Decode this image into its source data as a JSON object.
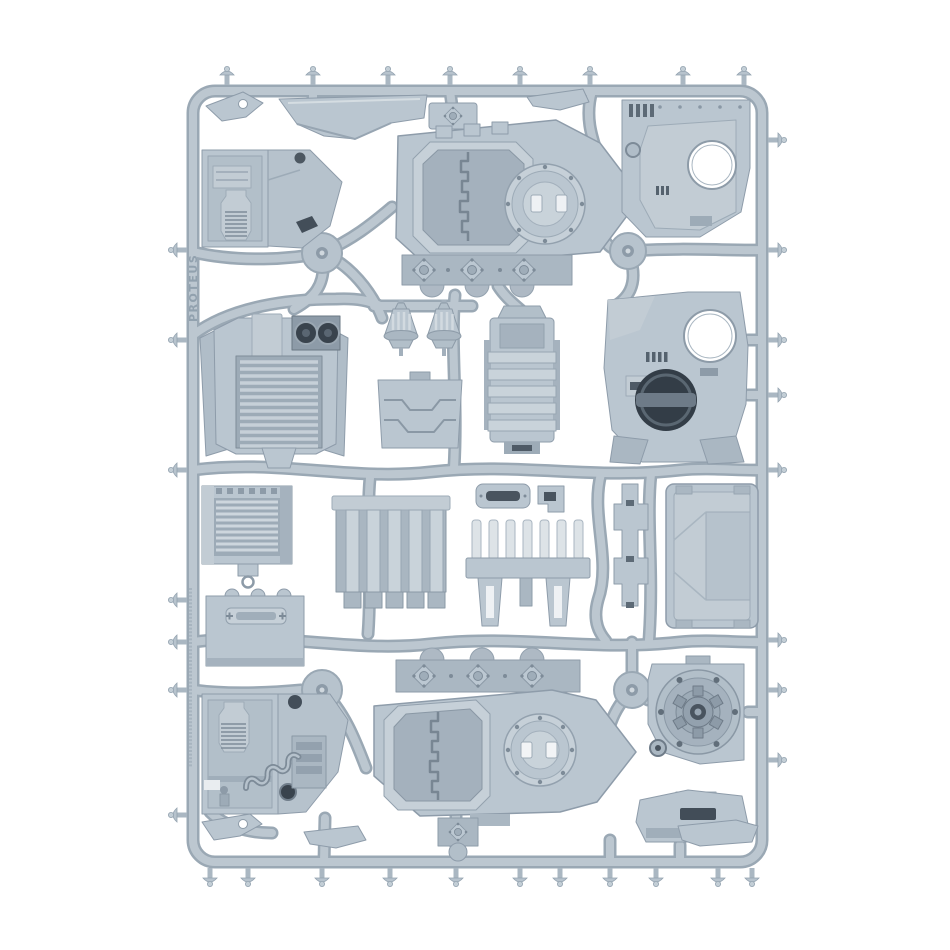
{
  "image": {
    "background_color": "#ffffff",
    "subject": "grey plastic injection-moulded model sprue with armoured-vehicle hull, door, hatch and engine parts"
  },
  "sprue": {
    "embossed_label": "PROTEUS",
    "palette": {
      "plastic_base": "#bac6d0",
      "plastic_light": "#ccd5dc",
      "plastic_highlight": "#e2e7eb",
      "plastic_shadow": "#97a5b2",
      "runner": "#bcc7d0",
      "runner_edge": "#9aa8b4",
      "recess_dark": "#5d6a76",
      "recess_deep": "#343e48",
      "hole_white": "#ffffff"
    },
    "parts": [
      {
        "name": "sensor-fin"
      },
      {
        "name": "glacis-plate"
      },
      {
        "name": "top-wedge"
      },
      {
        "name": "hinge-plate-top"
      },
      {
        "name": "interior-wall-upper"
      },
      {
        "name": "top-hull-front"
      },
      {
        "name": "side-door-panel-upper"
      },
      {
        "name": "engine-front-plate"
      },
      {
        "name": "exhaust-bell-left"
      },
      {
        "name": "exhaust-bell-right"
      },
      {
        "name": "access-hatch-plate"
      },
      {
        "name": "radiator-block"
      },
      {
        "name": "side-door-panel-lower"
      },
      {
        "name": "louvre-panel"
      },
      {
        "name": "hatch-door"
      },
      {
        "name": "exhaust-manifold-panel"
      },
      {
        "name": "vision-slit-plate"
      },
      {
        "name": "small-bracket"
      },
      {
        "name": "spike-rack"
      },
      {
        "name": "stepped-strip"
      },
      {
        "name": "roof-panel"
      },
      {
        "name": "interior-wall-lower"
      },
      {
        "name": "top-hull-rear"
      },
      {
        "name": "hub-hatch"
      },
      {
        "name": "rear-access-panel"
      },
      {
        "name": "blade-fin"
      },
      {
        "name": "bottom-wedge"
      },
      {
        "name": "bottom-bracket"
      },
      {
        "name": "bottom-hinge-plate"
      }
    ]
  }
}
